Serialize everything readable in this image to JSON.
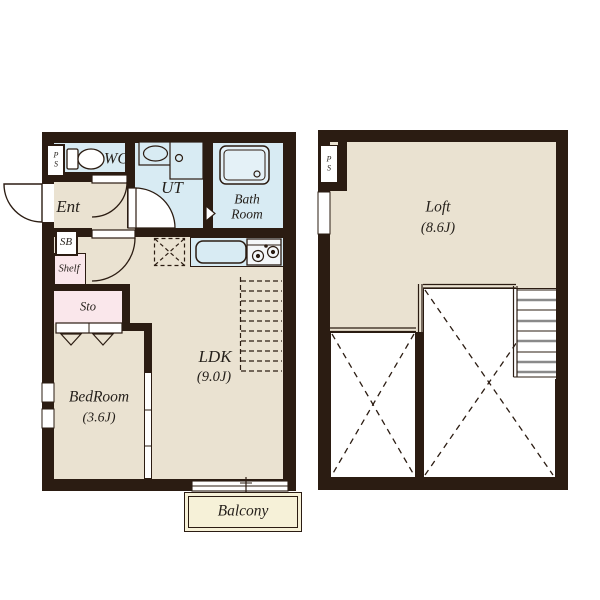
{
  "document": {
    "type": "apartment floor plan",
    "floors": [
      "first floor",
      "loft"
    ]
  },
  "labels": {
    "ps_first": "P\nS",
    "wc": "WC",
    "ut": "UT",
    "bath": "Bath\nRoom",
    "ent": "Ent",
    "sb": "SB",
    "shelf": "Shelf",
    "sto": "Sto",
    "bedroom": "BedRoom",
    "bedroom_size": "(3.6J)",
    "ldk": "LDK",
    "ldk_size": "(9.0J)",
    "balcony": "Balcony",
    "ps_loft": "P\nS",
    "loft": "Loft",
    "loft_size": "(8.6J)"
  },
  "colors": {
    "wall": "#2b1c12",
    "floor_beige": "#eae2d1",
    "wet_blue": "#d8ebf3",
    "closet_pink": "#fae7eb",
    "balcony_cream": "#f6f1d8",
    "text": "#241f1a",
    "white": "#ffffff"
  }
}
